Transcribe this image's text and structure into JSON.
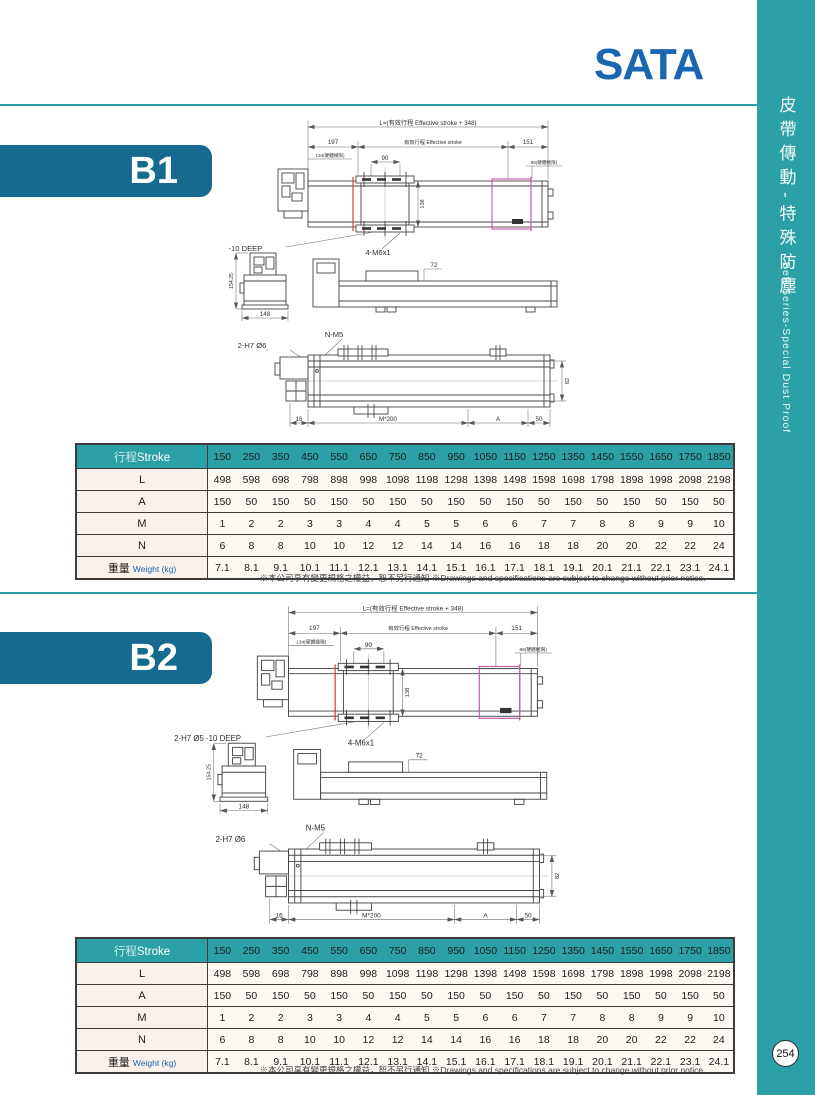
{
  "logo": {
    "text": "SATA"
  },
  "sidebar": {
    "title_zh": "皮帶傳動-特殊防塵",
    "title_en": "Belt Series-Special Dust Proof",
    "page_number": "254"
  },
  "sections": {
    "b1": {
      "label": "B1"
    },
    "b2": {
      "label": "B2"
    }
  },
  "drawing": {
    "dim_L": "L=(有效行程 Effective stroke + 348)",
    "dim_197": "197",
    "dim_effective": "有效行程 Effective stroke",
    "dim_151": "151",
    "dim_134": "134(硬體極限)",
    "dim_88": "88(硬體極限)",
    "dim_90": "90",
    "dim_138": "138",
    "label_top_holes": "2-H7 Ø5 -10 DEEP",
    "label_m6": "4-M6x1",
    "dim_154": "154.25",
    "dim_148": "148",
    "dim_72": "72",
    "label_nm5": "N-M5",
    "label_bottom_holes": "2-H7 Ø6",
    "dim_82": "82",
    "dim_16": "16",
    "dim_m200": "M*200",
    "dim_A": "A",
    "dim_50": "50"
  },
  "stroke_table": {
    "header": {
      "label_zh": "行程",
      "label_en": "Stroke",
      "strokes": [
        "150",
        "250",
        "350",
        "450",
        "550",
        "650",
        "750",
        "850",
        "950",
        "1050",
        "1150",
        "1250",
        "1350",
        "1450",
        "1550",
        "1650",
        "1750",
        "1850"
      ]
    },
    "rows": [
      {
        "label": "L",
        "values": [
          "498",
          "598",
          "698",
          "798",
          "898",
          "998",
          "1098",
          "1198",
          "1298",
          "1398",
          "1498",
          "1598",
          "1698",
          "1798",
          "1898",
          "1998",
          "2098",
          "2198"
        ]
      },
      {
        "label": "A",
        "values": [
          "150",
          "50",
          "150",
          "50",
          "150",
          "50",
          "150",
          "50",
          "150",
          "50",
          "150",
          "50",
          "150",
          "50",
          "150",
          "50",
          "150",
          "50"
        ]
      },
      {
        "label": "M",
        "values": [
          "1",
          "2",
          "2",
          "3",
          "3",
          "4",
          "4",
          "5",
          "5",
          "6",
          "6",
          "7",
          "7",
          "8",
          "8",
          "9",
          "9",
          "10"
        ]
      },
      {
        "label": "N",
        "values": [
          "6",
          "8",
          "8",
          "10",
          "10",
          "12",
          "12",
          "14",
          "14",
          "16",
          "16",
          "18",
          "18",
          "20",
          "20",
          "22",
          "22",
          "24"
        ]
      }
    ],
    "weight": {
      "label_zh": "重量",
      "label_en": "Weight (kg)",
      "values": [
        "7.1",
        "8.1",
        "9.1",
        "10.1",
        "11.1",
        "12.1",
        "13.1",
        "14.1",
        "15.1",
        "16.1",
        "17.1",
        "18.1",
        "19.1",
        "20.1",
        "21.1",
        "22.1",
        "23.1",
        "24.1"
      ]
    }
  },
  "note": {
    "zh": "※本公司享有變更規格之權益，恕不另行通知",
    "en": "※Drawings and specifications are subject to change without prior notice."
  },
  "colors": {
    "teal": "#2BA0A6",
    "tab_blue": "#166A8D",
    "logo_blue": "#1B66B0",
    "limit_red": "#D93025",
    "carriage_magenta": "#C558AE"
  }
}
